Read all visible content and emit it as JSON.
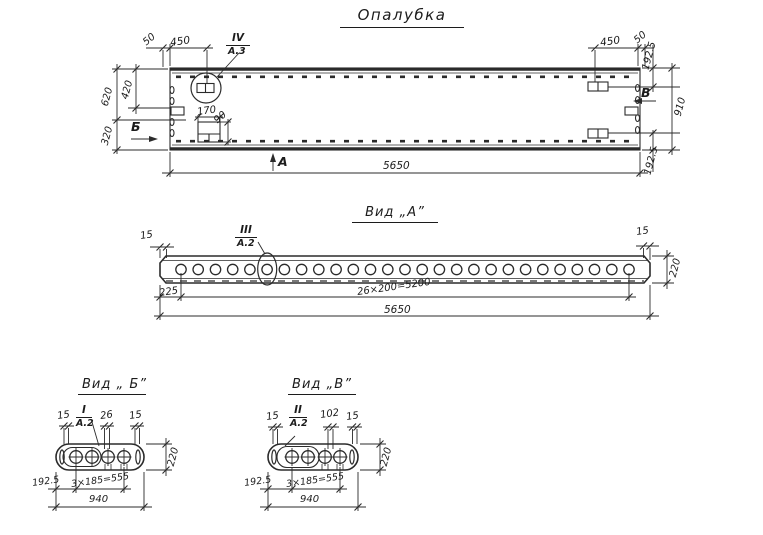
{
  "sheet": {
    "title": "Опалубка"
  },
  "plan": {
    "markers": {
      "a": "А",
      "b": "Б",
      "v": "В"
    },
    "callout": {
      "num": "IV",
      "sheet": "А.3"
    },
    "dims": {
      "d50_left": "50",
      "d450_left": "450",
      "d620": "620",
      "d420": "420",
      "d320": "320",
      "d170": "170",
      "d90": "90",
      "d450_right": "450",
      "d50_right": "50",
      "d192_top": "192.5",
      "d910": "910",
      "d192_bottom": "192.5",
      "total": "5650"
    }
  },
  "view_a": {
    "title": "Вид „А”",
    "callout": {
      "num": "III",
      "sheet": "А.2"
    },
    "hole_count": 27,
    "dims": {
      "d15_left": "15",
      "d15_right": "15",
      "d220": "220",
      "d225": "225",
      "spacing": "26×200=5200",
      "total": "5650"
    }
  },
  "view_b": {
    "title": "Вид „ Б”",
    "callout": {
      "num": "I",
      "sheet": "А.2"
    },
    "dims": {
      "d15_left": "15",
      "d26": "26",
      "d15_right": "15",
      "d220": "220",
      "d192": "192.5",
      "spacing": "3×185=555",
      "total": "940"
    }
  },
  "view_v": {
    "title": "Вид „В”",
    "callout": {
      "num": "II",
      "sheet": "А.2"
    },
    "dims": {
      "d15_left": "15",
      "d102": "102",
      "d15_right": "15",
      "d220": "220",
      "d192": "192.5",
      "spacing": "3×185=555",
      "total": "940"
    }
  }
}
